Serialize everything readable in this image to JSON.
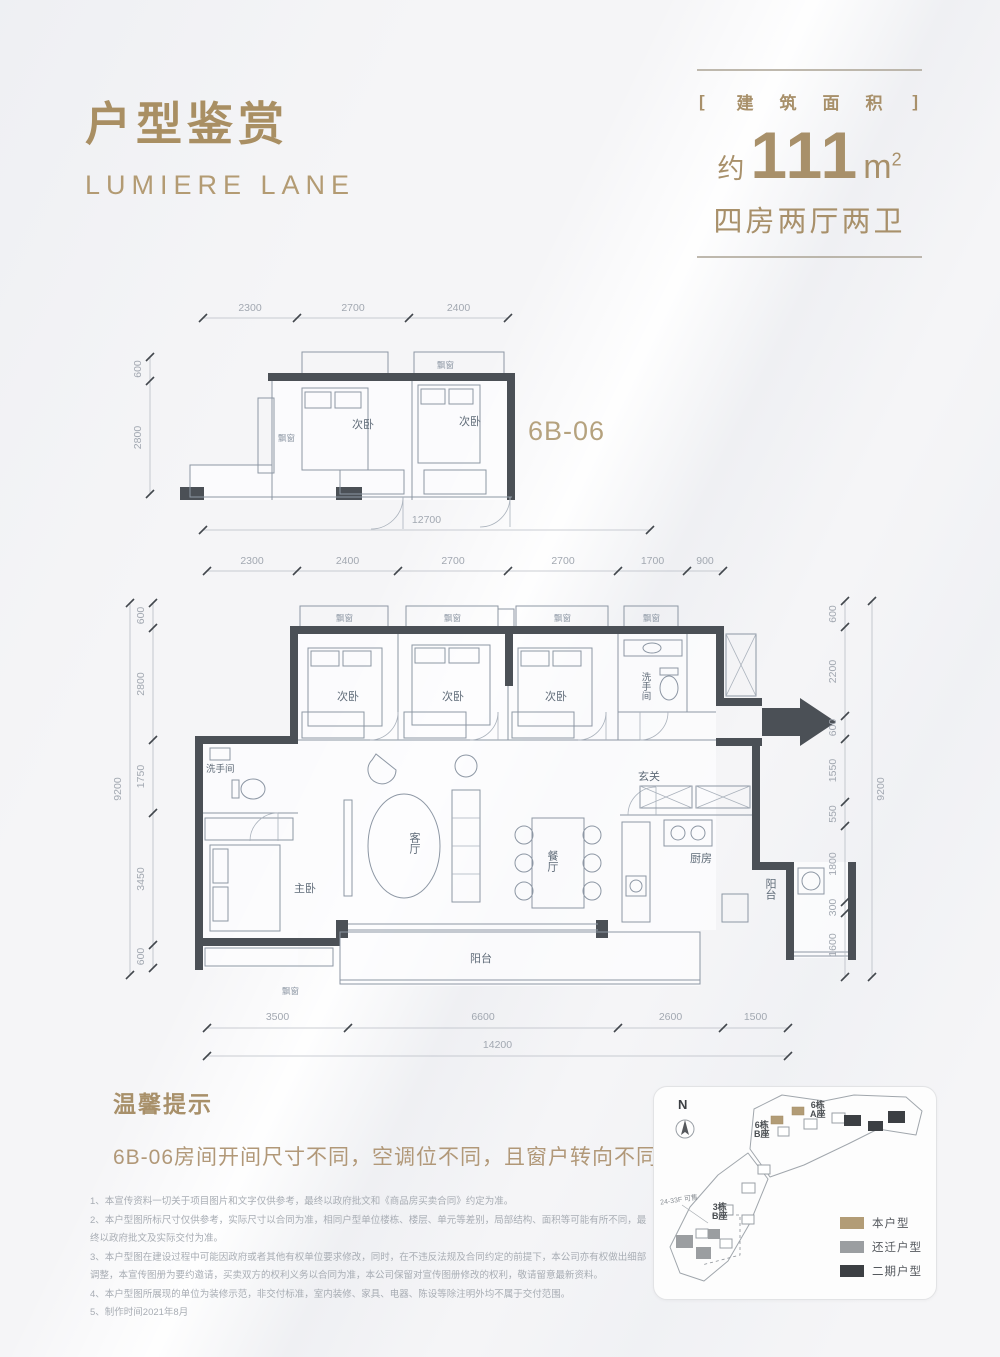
{
  "header": {
    "title": "户型鉴赏",
    "subtitle": "LUMIERE LANE"
  },
  "area_badge": {
    "bracket_open": "[",
    "bracket_close": "]",
    "category": "建筑面积",
    "approx": "约",
    "value": "111",
    "unit": "m",
    "unit_exp": "2",
    "layout": "四房两厅两卫"
  },
  "unit_code": "6B-06",
  "labels": {
    "bay_window": "飘窗",
    "secondary_bedroom": "次卧",
    "bathroom": "洗手间",
    "master_bedroom": "主卧",
    "living_room": "客厅",
    "dining_room": "餐厅",
    "entry": "玄关",
    "kitchen": "厨房",
    "balcony": "阳台"
  },
  "small_plan": {
    "dims_top": [
      "2300",
      "2700",
      "2400"
    ],
    "dims_left": [
      "600",
      "2800"
    ],
    "dim_total_bottom": "12700"
  },
  "main_plan": {
    "dims_top": [
      "2300",
      "2400",
      "2700",
      "2700",
      "1700",
      "900"
    ],
    "dims_bottom": [
      "3500",
      "6600",
      "2600",
      "1500"
    ],
    "dim_total_bottom": "14200",
    "dims_left": [
      "600",
      "2800",
      "1750",
      "3450",
      "600"
    ],
    "dim_total_left": "9200",
    "dims_right": [
      "600",
      "2200",
      "600",
      "1550",
      "550",
      "1800",
      "300",
      "1600"
    ],
    "dim_total_right": "9200"
  },
  "tips": {
    "title": "温馨提示",
    "body": "6B-06房间开间尺寸不同，空调位不同，且窗户转向不同"
  },
  "disclaimers": [
    "1、本宣传资料一切关于项目图片和文字仅供参考，最终以政府批文和《商品房买卖合同》约定为准。",
    "2、本户型图所标尺寸仅供参考，实际尺寸以合同为准，相同户型单位楼栋、楼层、单元等差别，局部结构、面积等可能有所不同，最终以政府批文及实际交付为准。",
    "3、本户型图在建设过程中可能因政府或者其他有权单位要求修改，同时，在不违反法规及合同约定的前提下，本公司亦有权做出细部调整，本宣传图册为要约邀请，买卖双方的权利义务以合同为准，本公司保留对宣传图册修改的权利，敬请留意最新资料。",
    "4、本户型图所展现的单位为装修示范，非交付标准，室内装修、家具、电器、陈设等除注明外均不属于交付范围。",
    "5、制作时间2021年8月"
  ],
  "site_map": {
    "north": "N",
    "sale_note": "24-33F 可售",
    "towers": {
      "t6b": {
        "l1": "6栋",
        "l2": "B座"
      },
      "t6a": {
        "l1": "6栋",
        "l2": "A座"
      },
      "t3b": {
        "l1": "3栋",
        "l2": "B座"
      }
    },
    "legend": [
      {
        "label": "本户型",
        "color": "#b29c76"
      },
      {
        "label": "还迁户型",
        "color": "#9b9ea1"
      },
      {
        "label": "二期户型",
        "color": "#3c3f43"
      }
    ]
  },
  "colors": {
    "accent_gold": "#a8906a",
    "wall": "#4b5056",
    "dim_text": "#a2a8b1"
  }
}
